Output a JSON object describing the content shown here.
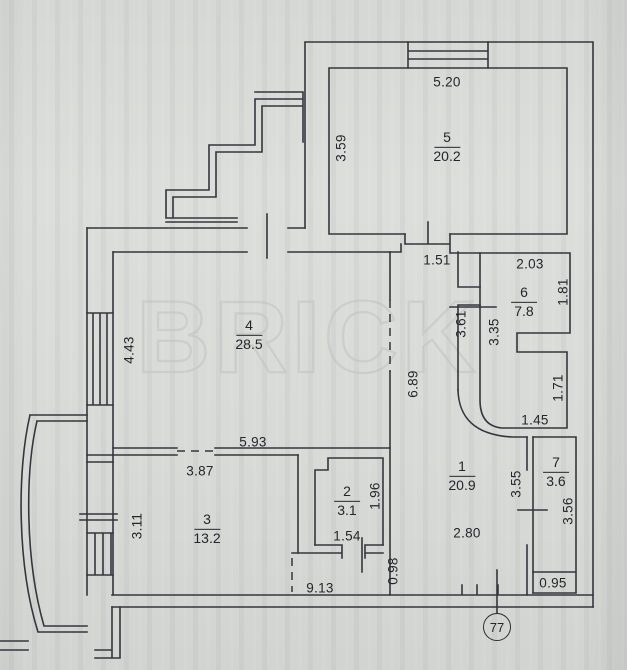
{
  "watermark": "BRICK",
  "badge": "77",
  "colors": {
    "line": "#33373d",
    "watermark": "#bfc3c0",
    "paper": "#d8dad7",
    "text": "#23262b"
  },
  "rooms": {
    "r1": {
      "number": "1",
      "area": "20.9"
    },
    "r2": {
      "number": "2",
      "area": "3.1"
    },
    "r3": {
      "number": "3",
      "area": "13.2"
    },
    "r4": {
      "number": "4",
      "area": "28.5"
    },
    "r5": {
      "number": "5",
      "area": "20.2"
    },
    "r6": {
      "number": "6",
      "area": "7.8"
    },
    "r7": {
      "number": "7",
      "area": "3.6"
    }
  },
  "dims": {
    "d520": "5.20",
    "d359": "3.59",
    "d151": "1.51",
    "d203": "2.03",
    "d181": "1.81",
    "d443": "4.43",
    "d361": "3.61",
    "d335": "3.35",
    "d689": "6.89",
    "d171": "1.71",
    "d145": "1.45",
    "d593": "5.93",
    "d387": "3.87",
    "d355": "3.55",
    "d356": "3.56",
    "d311": "3.11",
    "d196": "1.96",
    "d154": "1.54",
    "d280": "2.80",
    "d913": "9.13",
    "d098": "0.98",
    "d095": "0.95"
  }
}
